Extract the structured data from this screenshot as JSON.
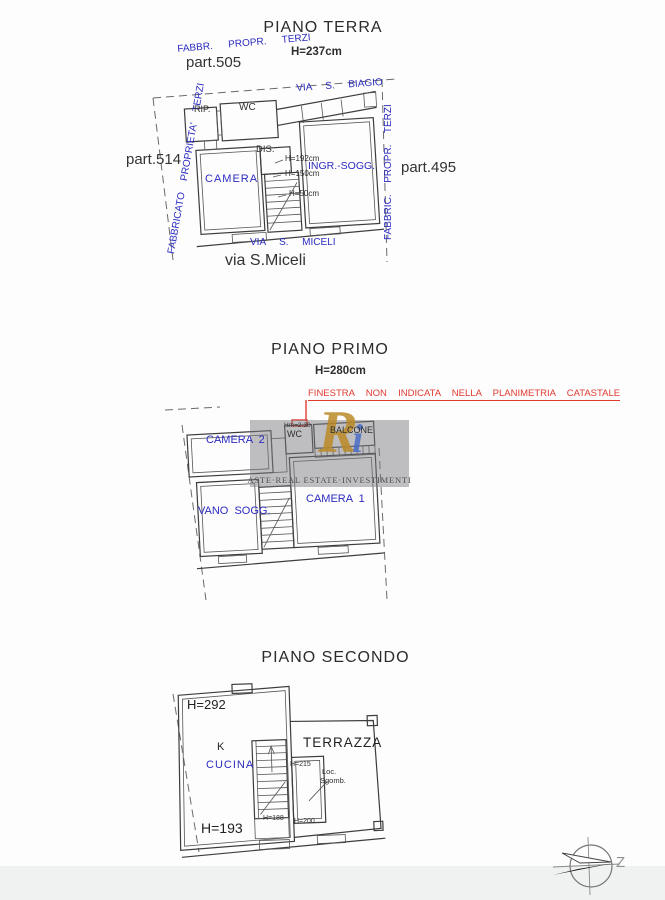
{
  "colors": {
    "blue": "#2b2bbf",
    "red": "#e03a30",
    "ink": "#2e2e2e"
  },
  "terra": {
    "title": "PIANO TERRA",
    "ceiling_height": "H=237cm",
    "boundary_top": "FABBR.  PROPR.  TERZI",
    "parcel_top": "part.505",
    "street_top": "VIA  S.  BIAGIO",
    "boundary_left": "FABBRICATO  PROPRIETA'  TERZI",
    "parcel_left": "part.514",
    "boundary_right": "FABBRIC.  PROPR.  TERZI",
    "parcel_right": "part.495",
    "rooms": {
      "rip": "RIP.",
      "wc": "WC",
      "dis": "DIS.",
      "camera": "CAMERA",
      "ingr_sogg": "INGR.-SOGG."
    },
    "heights": {
      "h1": "H=192cm",
      "h2": "H=150cm",
      "h3": "H=50cm"
    },
    "street_bottom": "VIA  S.  MICELI",
    "street_bottom_big": "via S.Miceli"
  },
  "primo": {
    "title": "PIANO PRIMO",
    "ceiling_height": "H=280cm",
    "note": "FINESTRA  NON  INDICATA  NELLA  PLANIMETRIA  CATASTALE",
    "rooms": {
      "camera2": "CAMERA  2",
      "hm": "Hm=2.30",
      "wc": "WC",
      "balcone": "BALCONE",
      "vano_sogg": "VANO  SOGG.",
      "camera1": "CAMERA  1"
    }
  },
  "secondo": {
    "title": "PIANO SECONDO",
    "rooms": {
      "k": "K",
      "cucina": "CUCINA",
      "terrazza": "TERRAZZA",
      "loc": "Loc.",
      "sgomb": "Sgomb."
    },
    "heights": {
      "h292": "H=292",
      "h215": "H=215",
      "h188": "H=188",
      "h200": "H=200",
      "h193": "H=193"
    }
  },
  "watermark": {
    "logo_r": "R",
    "logo_i": "i",
    "caption": "ASTE·REAL ESTATE·INVESTIMENTI"
  },
  "compass": {
    "label": "Z"
  }
}
